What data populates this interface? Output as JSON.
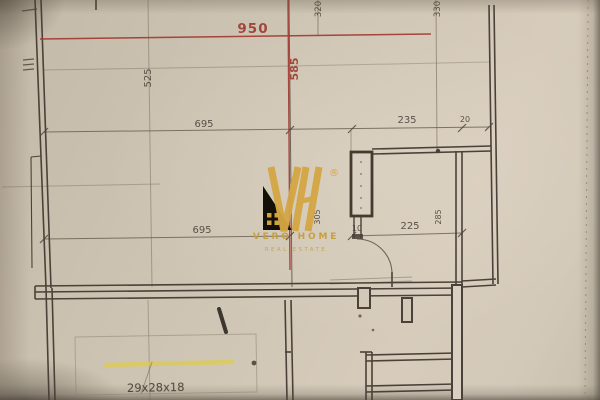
{
  "document_type": "scanned floor plan photo",
  "plan": {
    "dims": {
      "overall_width": "950",
      "interior_height": "585",
      "left_segment_height": "525",
      "upper_room_width": "695",
      "recess_width": "235",
      "gap_width": "20",
      "lower_room_width": "695",
      "shaft_offset": "10",
      "corridor_width": "225",
      "left_wall_height": "305",
      "right_wall_height": "285",
      "top_edge_left": "320",
      "top_edge_right": "330"
    },
    "annotations": {
      "stair_note": "29x28x18"
    }
  },
  "watermark": {
    "monogram": "VH",
    "registered_mark": "®",
    "brand_name": "VERO HOME",
    "brand_tagline": "REAL ESTATE"
  },
  "colors": {
    "paper": "#cdc3b1",
    "ink": "#4a4037",
    "red_dimension": "#a23a31",
    "gold_logo": "#d2a344",
    "highlighter_yellow": "#ddcb4e",
    "pencil": "#8a7f6e",
    "marker_black": "#2e2822"
  }
}
